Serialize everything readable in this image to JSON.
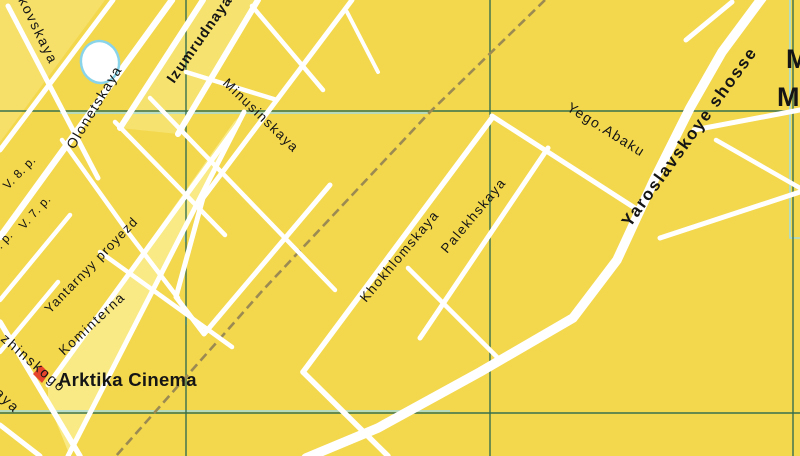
{
  "map": {
    "title": "City street map section (Moscow area, transliterated names)",
    "background_color": "#F3D74D",
    "colors": {
      "street": "#FFFFFF",
      "grid_green": "#2E6B4F",
      "route_blue": "#9ADCEF",
      "railway_brown": "#9B8A52",
      "block_pale": "#F9EA85",
      "label_black": "#151515",
      "poi_marker_red": "#E6452D",
      "pond_stroke_blue": "#8AD4EA"
    },
    "grid": {
      "vertical_x": [
        186,
        490,
        793
      ],
      "horizontal_y": [
        111,
        413
      ]
    },
    "blue_accents": [
      {
        "id": "h1-route",
        "points": [
          [
            60,
            113
          ],
          [
            430,
            113
          ]
        ]
      },
      {
        "id": "h2-route",
        "points": [
          [
            0,
            411
          ],
          [
            450,
            411
          ]
        ]
      },
      {
        "id": "v3-route",
        "points": [
          [
            790,
            0
          ],
          [
            790,
            238
          ],
          [
            800,
            238
          ]
        ]
      },
      {
        "id": "v1-route-a",
        "points": [
          [
            185.5,
            222
          ],
          [
            185.5,
            242
          ]
        ]
      },
      {
        "id": "v1-route-b",
        "points": [
          [
            186,
            305
          ],
          [
            186,
            325
          ]
        ]
      }
    ],
    "railway": {
      "id": "railway-line",
      "points": [
        [
          545,
          0
        ],
        [
          430,
          112
        ],
        [
          263,
          290
        ],
        [
          116,
          456
        ]
      ],
      "width": 2.6,
      "dash": "9 5"
    },
    "blocks": [
      {
        "id": "block-kominterna-strip",
        "points": [
          [
            48,
            385
          ],
          [
            234,
            122
          ],
          [
            246,
            110
          ],
          [
            70,
            456
          ],
          [
            48,
            402
          ]
        ],
        "opacity": 1
      },
      {
        "id": "block-izumrudnaya-strip",
        "points": [
          [
            120,
            128
          ],
          [
            203,
            0
          ],
          [
            258,
            0
          ],
          [
            178,
            134
          ]
        ],
        "opacity": 0.6
      },
      {
        "id": "block-northwest-corner",
        "points": [
          [
            0,
            0
          ],
          [
            105,
            0
          ],
          [
            0,
            142
          ]
        ],
        "opacity": 0.5
      }
    ],
    "streets": [
      {
        "id": "olonetskaya-street",
        "points": [
          [
            0,
            237
          ],
          [
            172,
            0
          ]
        ],
        "width": 6.5
      },
      {
        "id": "west-parallel-street",
        "points": [
          [
            0,
            150
          ],
          [
            113,
            0
          ]
        ],
        "width": 5
      },
      {
        "id": "kovskaya-street",
        "points": [
          [
            8,
            6
          ],
          [
            98,
            178
          ]
        ],
        "width": 5
      },
      {
        "id": "v8-alley",
        "points": [
          [
            0,
            300
          ],
          [
            70,
            215
          ]
        ],
        "width": 4.5
      },
      {
        "id": "v7-alley",
        "points": [
          [
            0,
            352
          ],
          [
            58,
            282
          ]
        ],
        "width": 4.5
      },
      {
        "id": "olonetskaya-cross-street",
        "points": [
          [
            62,
            140
          ],
          [
            130,
            235
          ],
          [
            178,
            298
          ]
        ],
        "width": 4.5
      },
      {
        "id": "yantarnyy-proyezd-street",
        "points": [
          [
            48,
            385
          ],
          [
            238,
            124
          ]
        ],
        "width": 5
      },
      {
        "id": "kominterna-street",
        "points": [
          [
            68,
            456
          ],
          [
            244,
            112
          ]
        ],
        "width": 5
      },
      {
        "id": "izumrudnaya-street-left",
        "points": [
          [
            120,
            128
          ],
          [
            203,
            0
          ]
        ],
        "width": 6
      },
      {
        "id": "izumrudnaya-street-right",
        "points": [
          [
            178,
            134
          ],
          [
            258,
            0
          ]
        ],
        "width": 6
      },
      {
        "id": "minusinskaya-street-zigzag",
        "points": [
          [
            352,
            0
          ],
          [
            203,
            198
          ],
          [
            176,
            297
          ],
          [
            204,
            334
          ],
          [
            330,
            185
          ]
        ],
        "width": 5
      },
      {
        "id": "se-cross-street-1",
        "points": [
          [
            150,
            98
          ],
          [
            335,
            290
          ]
        ],
        "width": 4.5
      },
      {
        "id": "se-cross-street-2",
        "points": [
          [
            115,
            122
          ],
          [
            225,
            235
          ]
        ],
        "width": 4.5
      },
      {
        "id": "se-cross-street-3",
        "points": [
          [
            100,
            252
          ],
          [
            232,
            347
          ]
        ],
        "width": 4.5
      },
      {
        "id": "connector-street",
        "points": [
          [
            186,
            72
          ],
          [
            277,
            100
          ]
        ],
        "width": 4.5
      },
      {
        "id": "top-stub-street-1",
        "points": [
          [
            252,
            6
          ],
          [
            323,
            90
          ]
        ],
        "width": 4.5
      },
      {
        "id": "top-stub-street-2",
        "points": [
          [
            347,
            12
          ],
          [
            378,
            72
          ]
        ],
        "width": 4
      },
      {
        "id": "khokhlomskaya-street",
        "points": [
          [
            303,
            372
          ],
          [
            492,
            118
          ]
        ],
        "width": 5.5
      },
      {
        "id": "khokhlomskaya-south-street",
        "points": [
          [
            303,
            372
          ],
          [
            388,
            456
          ]
        ],
        "width": 5.5
      },
      {
        "id": "palekhskaya-street",
        "points": [
          [
            420,
            338
          ],
          [
            548,
            148
          ]
        ],
        "width": 5
      },
      {
        "id": "central-cross-street",
        "points": [
          [
            408,
            268
          ],
          [
            500,
            360
          ]
        ],
        "width": 4.5
      },
      {
        "id": "yego-abakumova-street",
        "points": [
          [
            492,
            116
          ],
          [
            641,
            212
          ]
        ],
        "width": 5
      },
      {
        "id": "yaroslavskoye-shosse-road",
        "points": [
          [
            765,
            -6
          ],
          [
            722,
            52
          ],
          [
            690,
            108
          ],
          [
            654,
            180
          ],
          [
            617,
            260
          ],
          [
            573,
            318
          ],
          [
            480,
            372
          ],
          [
            378,
            428
          ],
          [
            306,
            458
          ]
        ],
        "width": 9.5
      },
      {
        "id": "east-branch-north",
        "points": [
          [
            686,
            40
          ],
          [
            732,
            2
          ]
        ],
        "width": 5
      },
      {
        "id": "east-branch-mid",
        "points": [
          [
            694,
            130
          ],
          [
            800,
            110
          ]
        ],
        "width": 5
      },
      {
        "id": "east-branch-diagonal",
        "points": [
          [
            716,
            140
          ],
          [
            800,
            188
          ]
        ],
        "width": 4.5
      },
      {
        "id": "east-branch-south",
        "points": [
          [
            660,
            238
          ],
          [
            800,
            192
          ]
        ],
        "width": 5
      },
      {
        "id": "dzerzhinskogo-street",
        "points": [
          [
            0,
            322
          ],
          [
            80,
            456
          ]
        ],
        "width": 5.5
      },
      {
        "id": "southwest-parallel-street",
        "points": [
          [
            0,
            425
          ],
          [
            40,
            456
          ]
        ],
        "width": 5
      }
    ],
    "pond": {
      "id": "pond",
      "cx": 100,
      "cy": 62,
      "rx": 19,
      "ry": 21,
      "rotate": -12
    },
    "poi_marker": {
      "id": "arktika-cinema-marker",
      "points": [
        [
          41,
          365
        ],
        [
          49,
          373
        ],
        [
          42,
          383
        ],
        [
          33,
          374
        ]
      ]
    },
    "labels": [
      {
        "id": "label-kovskaya",
        "text": "kovskaya",
        "x": 18,
        "y": 0,
        "rot": 64,
        "size": 14,
        "ls": 1.8,
        "bold": false
      },
      {
        "id": "label-olonetskaya",
        "text": "Olonetskaya",
        "x": 74,
        "y": 150,
        "rot": -59,
        "size": 14,
        "ls": 1.5,
        "bold": false
      },
      {
        "id": "label-v8-proyezd",
        "text": "V. 8. p.",
        "x": 8,
        "y": 190,
        "rot": -46,
        "size": 12,
        "ls": 0.5,
        "bold": false
      },
      {
        "id": "label-v7-proyezd",
        "text": "V. 7. p.",
        "x": 24,
        "y": 230,
        "rot": -48,
        "size": 12,
        "ls": 0.5,
        "bold": false
      },
      {
        "id": "label-v6-proyezd",
        "text": "V. 6. p.",
        "x": -14,
        "y": 266,
        "rot": -48,
        "size": 12,
        "ls": 0.5,
        "bold": false
      },
      {
        "id": "label-izumrudnaya",
        "text": "Izumrudnaya",
        "x": 174,
        "y": 84,
        "rot": -55,
        "size": 14.5,
        "ls": 1.2,
        "bold": true
      },
      {
        "id": "label-minusinskaya",
        "text": "Minusinskaya",
        "x": 222,
        "y": 84,
        "rot": 44,
        "size": 13.5,
        "ls": 1.5,
        "bold": false
      },
      {
        "id": "label-yantarnyy-proyezd",
        "text": "Yantarnyy proyezd",
        "x": 50,
        "y": 314,
        "rot": -46,
        "size": 13,
        "ls": 1.2,
        "bold": false
      },
      {
        "id": "label-kominterna",
        "text": "Kominterna",
        "x": 64,
        "y": 356,
        "rot": -43,
        "size": 13.5,
        "ls": 1.6,
        "bold": false
      },
      {
        "id": "label-khokhlomskaya",
        "text": "Khokhlomskaya",
        "x": 366,
        "y": 303,
        "rot": -50,
        "size": 13.5,
        "ls": 1.5,
        "bold": false
      },
      {
        "id": "label-palekhskaya",
        "text": "Palekhskaya",
        "x": 447,
        "y": 254,
        "rot": -50,
        "size": 13.5,
        "ls": 1.5,
        "bold": false
      },
      {
        "id": "label-yego-abaku",
        "text": "Yego.Abaku",
        "x": 566,
        "y": 110,
        "rot": 32,
        "size": 14,
        "ls": 1.4,
        "bold": false
      },
      {
        "id": "label-yaroslavskoye-shosse",
        "text": "Yaroslavskoye shosse",
        "x": 630,
        "y": 228,
        "rot": -54,
        "size": 17,
        "ls": 1.8,
        "bold": true
      },
      {
        "id": "label-zhinskogo",
        "text": "zhinskogo",
        "x": 0,
        "y": 340,
        "rot": 41,
        "size": 14,
        "ls": 2,
        "bold": false
      },
      {
        "id": "label-aya-fragment",
        "text": "aya",
        "x": -6,
        "y": 394,
        "rot": 44,
        "size": 14,
        "ls": 2,
        "bold": false
      },
      {
        "id": "label-arktika-cinema",
        "text": "Arktika Cinema",
        "x": 58,
        "y": 386,
        "rot": 0,
        "size": 18.5,
        "ls": 0.3,
        "bold": true
      },
      {
        "id": "label-region-line1",
        "text": "M",
        "x": 786,
        "y": 68,
        "rot": 0,
        "size": 27,
        "ls": 0,
        "bold": true
      },
      {
        "id": "label-region-line2",
        "text": "M",
        "x": 777,
        "y": 106,
        "rot": 0,
        "size": 27,
        "ls": 0,
        "bold": true
      }
    ]
  }
}
